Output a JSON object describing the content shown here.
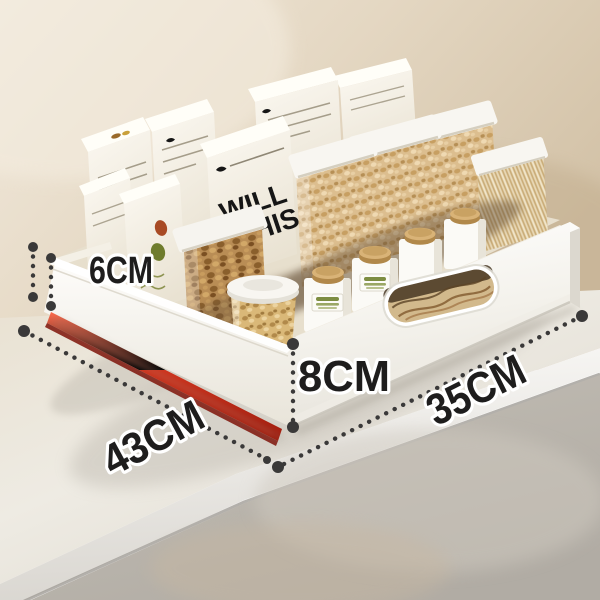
{
  "annotations": {
    "side_height": "6CM",
    "front_height": "8CM",
    "depth": "43CM",
    "width": "35CM"
  },
  "box_print": {
    "line1": "WILL",
    "line2": "WHIS"
  },
  "colors": {
    "rail_red": "#D93120",
    "annotation_dark": "#3A3939",
    "wall_beige": "#E2D4BD",
    "counter_white": "#EBE6DC",
    "floor_grey": "#B6B1A9",
    "wood_cap_tan": "#C49A5E"
  }
}
